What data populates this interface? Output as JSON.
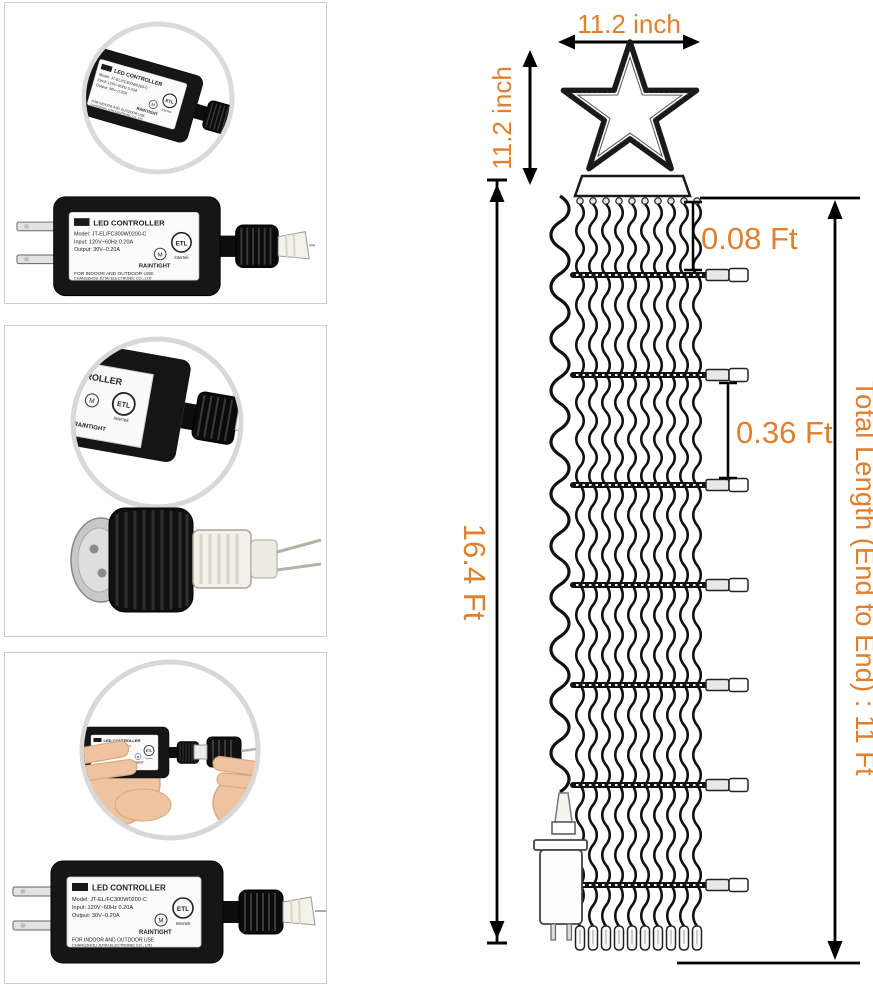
{
  "annotations": {
    "star_width": "11.2 inch",
    "star_height": "11.2 inch",
    "first_drop": "0.08 Ft",
    "row_gap": "0.36 Ft",
    "wire_length": "16.4 Ft",
    "total_length": "Total Length (End to End) : 11 Ft"
  },
  "controller": {
    "title": "LED CONTROLLER",
    "title_partial": "TROLLER",
    "model": "Model: JT-EL/FC300W0200-C",
    "input": "Input: 120V~60Hz 0.20A",
    "output": "Output: 30V–0.20A",
    "cert": "ETL",
    "cert_sub": "Intertek",
    "mark": "M",
    "rating": "RAINTIGHT",
    "usage": "FOR INDOOR AND OUTDOOR USE",
    "maker": "CHANGZHOU JUTAI ELECTRONIC CO., LTD"
  },
  "colors": {
    "accent": "#E0802F",
    "line": "#000000",
    "panel_border": "#CCCCCC"
  }
}
